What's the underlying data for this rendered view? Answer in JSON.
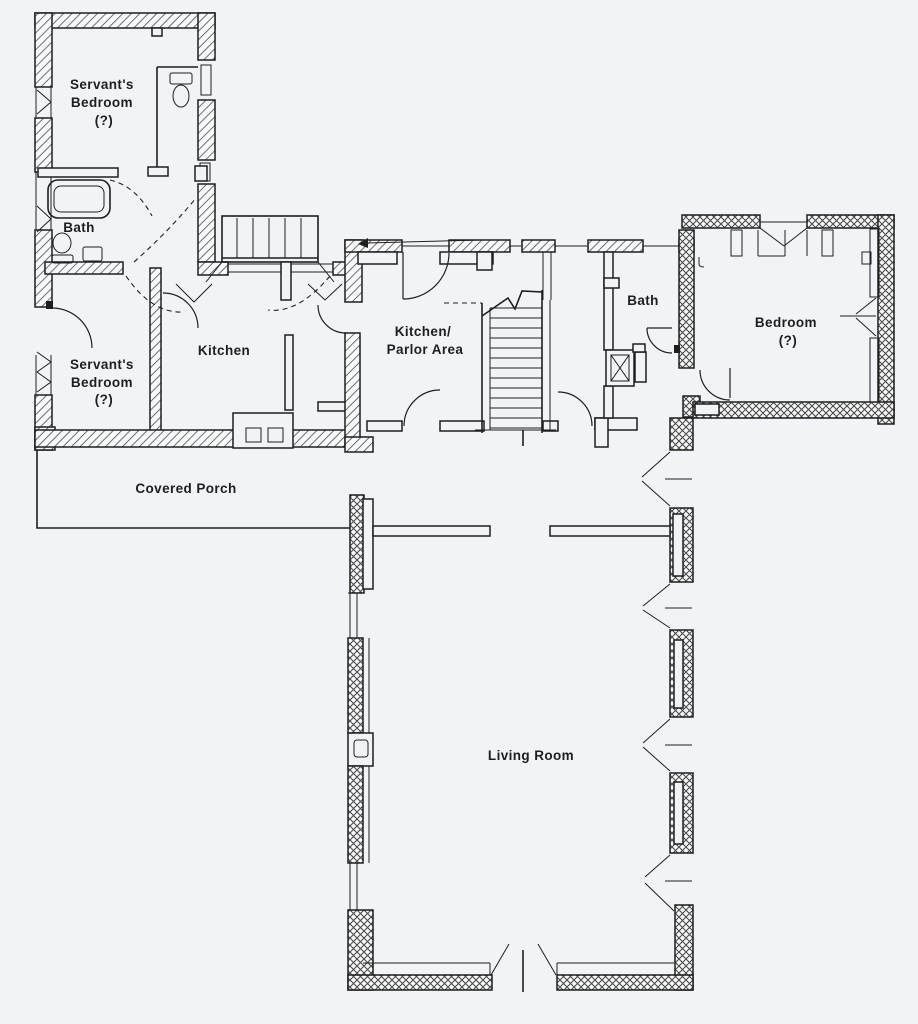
{
  "colors": {
    "paper": "#f1f4f7",
    "ink": "#1e1e1e",
    "hatch": "#4a4a4a",
    "wallfill": "#f8f9fa"
  },
  "rooms": [
    {
      "id": "servants-bedroom-upper",
      "label": "Servant's Bedroom (?)",
      "lines": [
        "Servant's",
        "Bedroom",
        "(?)"
      ]
    },
    {
      "id": "bath-upper-left",
      "label": "Bath",
      "lines": [
        "Bath"
      ]
    },
    {
      "id": "servants-bedroom-lower",
      "label": "Servant's Bedroom (?)",
      "lines": [
        "Servant's",
        "Bedroom",
        "(?)"
      ]
    },
    {
      "id": "kitchen",
      "label": "Kitchen",
      "lines": [
        "Kitchen"
      ]
    },
    {
      "id": "kitchen-parlor-area",
      "label": "Kitchen/ Parlor Area",
      "lines": [
        "Kitchen/",
        "Parlor Area"
      ]
    },
    {
      "id": "bath-right",
      "label": "Bath",
      "lines": [
        "Bath"
      ]
    },
    {
      "id": "bedroom-right",
      "label": "Bedroom (?)",
      "lines": [
        "Bedroom",
        "(?)"
      ]
    },
    {
      "id": "covered-porch",
      "label": "Covered Porch",
      "lines": [
        "Covered Porch"
      ]
    },
    {
      "id": "living-room",
      "label": "Living Room",
      "lines": [
        "Living Room"
      ]
    }
  ],
  "fixtures": [
    "bathtub",
    "toilet",
    "sink",
    "water-closet",
    "kitchen-stove",
    "kitchen-counter",
    "staircase",
    "stair-break-line",
    "back-steps",
    "chimney-shaft",
    "closet",
    "casement-windows",
    "door-swings",
    "double-entry-door"
  ]
}
